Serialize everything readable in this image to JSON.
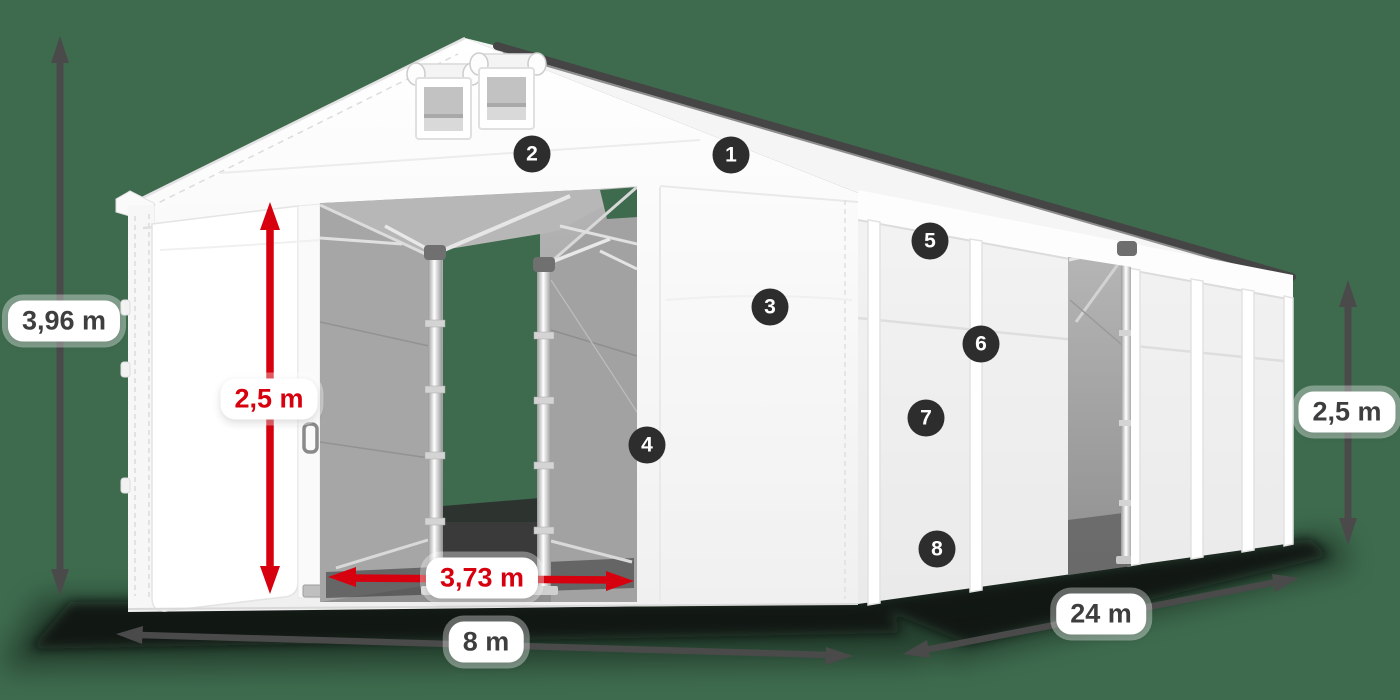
{
  "scene": {
    "description": "Isometric product diagram of a white storage tent hall with dimension arrows and numbered feature hotspots",
    "background_color": "#3e6b4e",
    "accent_red": "#d7000e",
    "dimension_gray": "#4a4a4a",
    "badge_color": "#2d2d2d",
    "tent_color": "#ffffff"
  },
  "dimensions": {
    "total_height": {
      "label": "3,96 m",
      "style": "gray",
      "orientation": "vertical-left"
    },
    "door_height": {
      "label": "2,5 m",
      "style": "red",
      "orientation": "vertical-front-door"
    },
    "door_width": {
      "label": "3,73 m",
      "style": "red",
      "orientation": "horizontal-door"
    },
    "front_width": {
      "label": "8 m",
      "style": "gray",
      "orientation": "horizontal-front"
    },
    "side_length": {
      "label": "24 m",
      "style": "gray",
      "orientation": "diagonal-side"
    },
    "side_height": {
      "label": "2,5 m",
      "style": "gray",
      "orientation": "vertical-right"
    }
  },
  "badges": [
    {
      "number": "1"
    },
    {
      "number": "2"
    },
    {
      "number": "3"
    },
    {
      "number": "4"
    },
    {
      "number": "5"
    },
    {
      "number": "6"
    },
    {
      "number": "7"
    },
    {
      "number": "8"
    }
  ]
}
